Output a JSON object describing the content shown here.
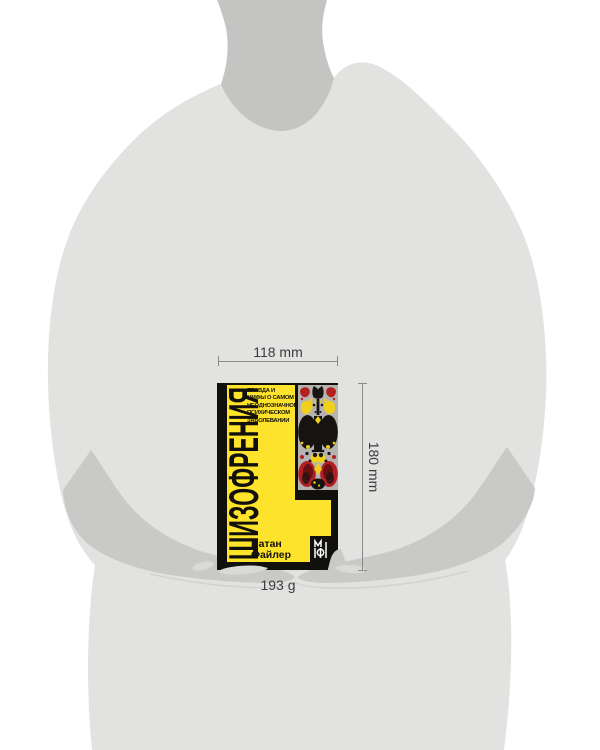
{
  "annotations": {
    "width_label": "118 mm",
    "height_label": "180 mm",
    "weight_label": "193 g"
  },
  "book": {
    "title": "ШИЗОФРЕНИЯ",
    "subtitle": [
      "ПРАВДА И",
      "МИФЫ О САМОМ",
      "НЕОДНОЗНАЧНОМ",
      "ПСИХИЧЕСКОМ",
      "ЗАБОЛЕВАНИИ"
    ],
    "author": [
      "Натан",
      "Файлер"
    ],
    "publisher_logo_icon": "mif-monogram",
    "colors": {
      "cover_yellow": "#fde32b",
      "cover_black": "#12100d",
      "strip_gray": "#b5b3b1",
      "blot_red": "#b2211f",
      "blot_black": "#161310"
    }
  },
  "figure": {
    "torso_color": "#e2e2e1",
    "neck_color": "#c4c4c3",
    "arm_color": "#c9c9c8",
    "background_color": "#ffffff"
  }
}
